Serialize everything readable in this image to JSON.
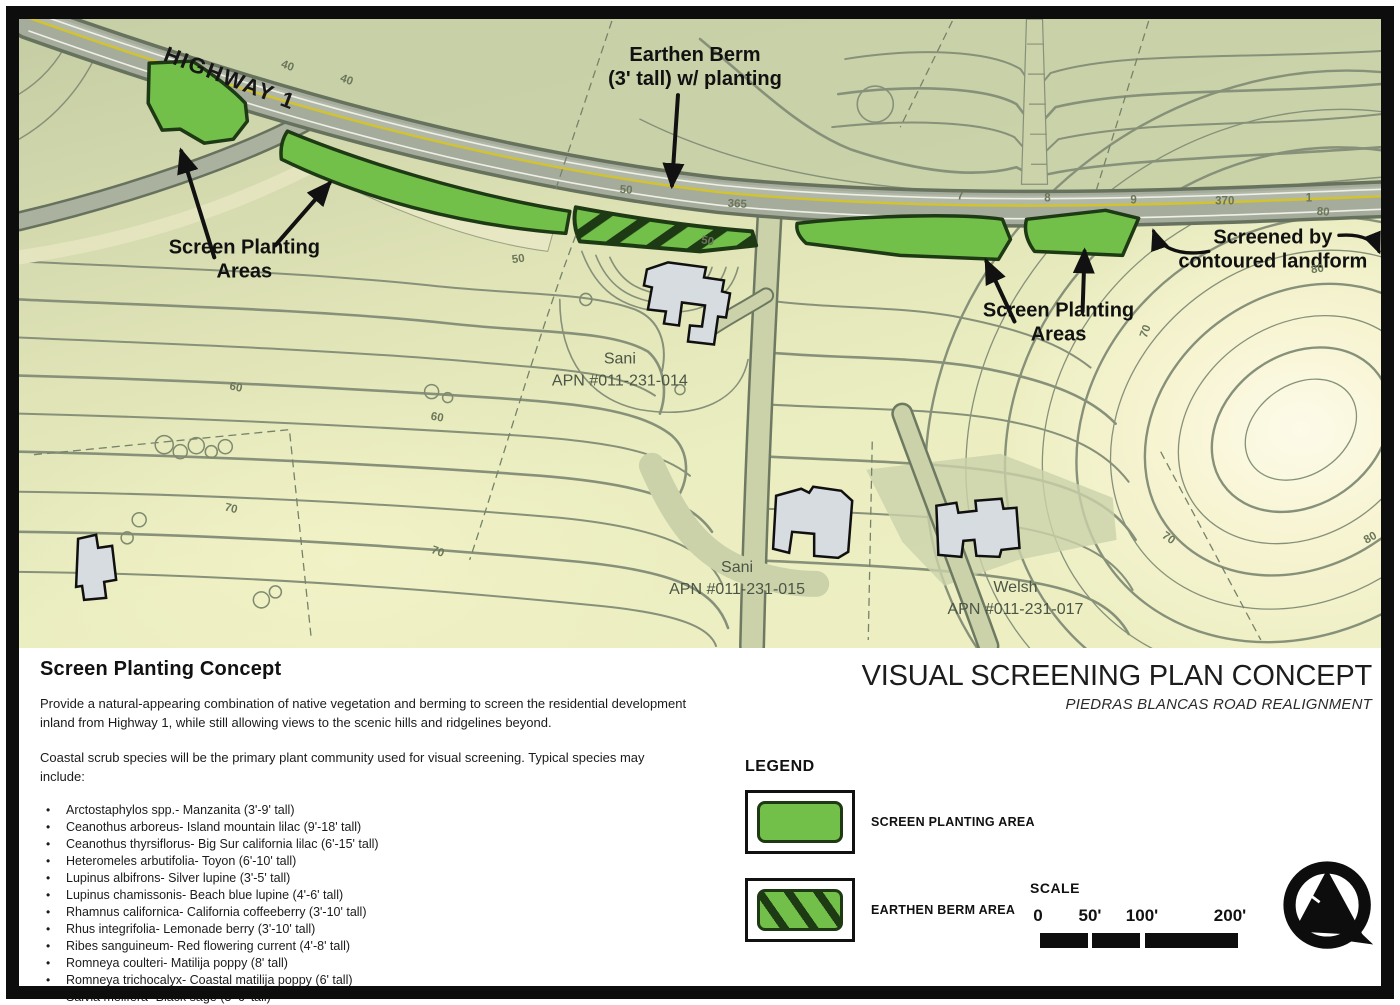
{
  "map": {
    "highway_label": "HIGHWAY 1",
    "annotations": {
      "earthen_berm": [
        "Earthen Berm",
        "(3' tall) w/ planting"
      ],
      "screen_planting_left": [
        "Screen Planting",
        "Areas"
      ],
      "screen_planting_right": [
        "Screen Planting",
        "Areas"
      ],
      "screened_by": [
        "Screened by",
        "contoured landform"
      ]
    },
    "parcels": [
      {
        "name": "Sani",
        "apn": "APN #011-231-014"
      },
      {
        "name": "Sani",
        "apn": "APN #011-231-015"
      },
      {
        "name": "Welsh",
        "apn": "APN #011-231-017"
      }
    ],
    "contour_labels": [
      "40",
      "40",
      "50",
      "365",
      "50",
      "50",
      "7",
      "8",
      "9",
      "370",
      "1",
      "60",
      "60",
      "70",
      "70",
      "70",
      "70",
      "80",
      "80",
      "80"
    ]
  },
  "panel": {
    "concept": {
      "heading": "Screen Planting Concept",
      "para1": "Provide a natural-appearing combination of native vegetation and berming to screen the residential development inland from Highway 1, while still allowing views to the scenic hills and ridgelines beyond.",
      "para2": "Coastal scrub species will be the primary plant community used for visual screening. Typical species may include:",
      "species": [
        "Arctostaphylos spp.-  Manzanita (3'-9' tall)",
        "Ceanothus arboreus-  Island mountain lilac (9'-18' tall)",
        "Ceanothus thyrsiflorus-  Big Sur california lilac (6'-15' tall)",
        "Heteromeles arbutifolia-  Toyon (6'-10' tall)",
        "Lupinus albifrons-  Silver lupine (3'-5' tall)",
        "Lupinus chamissonis-  Beach blue lupine (4'-6' tall)",
        "Rhamnus californica-  California coffeeberry (3'-10' tall)",
        "Rhus integrifolia-  Lemonade berry (3'-10' tall)",
        "Ribes sanguineum-  Red flowering current (4'-8' tall)",
        "Romneya coulteri-  Matilija poppy (8' tall)",
        "Romneya trichocalyx-  Coastal matilija poppy (6' tall)",
        "Salvia melifera-  Black sage (3'-6' tall)",
        "Sambucus mexicanus-  Blue elderberry (4'-12' tall)"
      ]
    },
    "title_block": {
      "title": "VISUAL SCREENING PLAN CONCEPT",
      "subtitle": "PIEDRAS BLANCAS ROAD REALIGNMENT"
    },
    "legend": {
      "heading": "LEGEND",
      "items": [
        {
          "label": "SCREEN PLANTING AREA",
          "style": "solid"
        },
        {
          "label": "EARTHEN BERM AREA",
          "style": "hatched"
        }
      ]
    },
    "scale": {
      "heading": "SCALE",
      "ticks": [
        "0",
        "50'",
        "100'",
        "200'"
      ]
    }
  },
  "colors": {
    "planting_green": "#72c04a",
    "berm_stripe_dark": "#1e3a15",
    "highway_yellow": "#d3c32c",
    "map_sage": "#c7cfa6",
    "map_pale": "#ecefc1"
  }
}
